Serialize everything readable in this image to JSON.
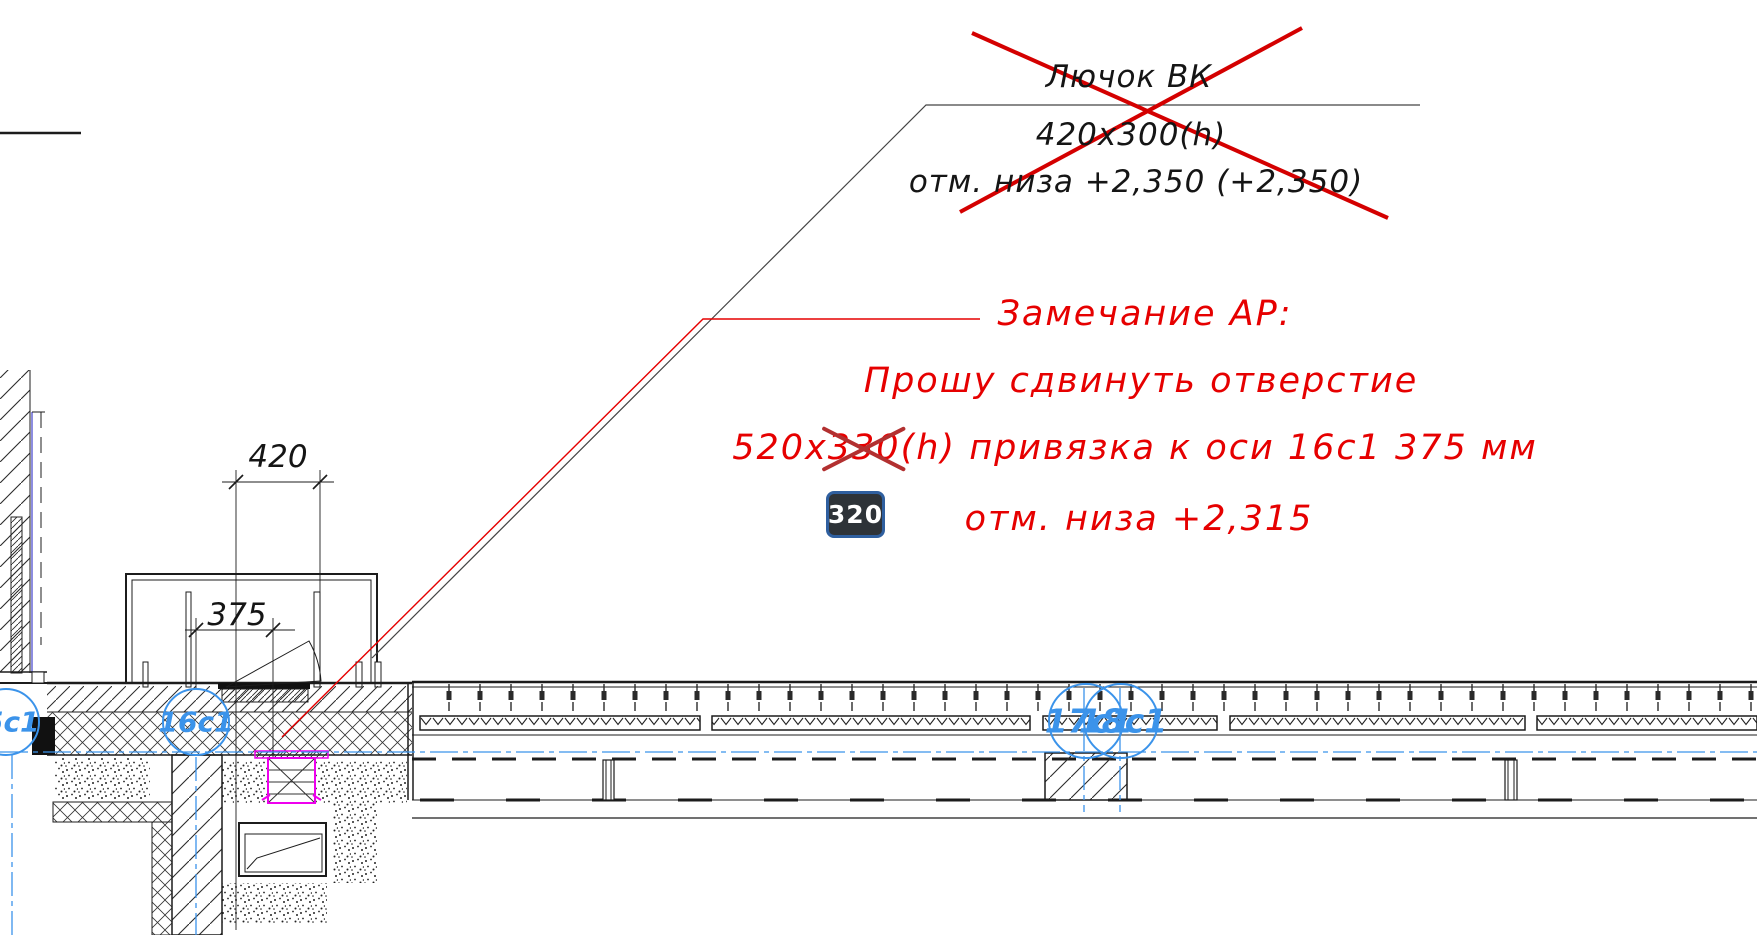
{
  "old_note": {
    "line1": "Лючок ВК",
    "line2": "420х300(h)",
    "line3": "отм. низа  +2,350  (+2,350)"
  },
  "ap_note": {
    "line1": "Замечание АР:",
    "line2": "Прошу сдвинуть отверстие",
    "line3_pre": "520х",
    "line3_strike": "330",
    "line3_post": "(h) привязка к оси  16с1 375 мм",
    "line4": "отм. низа  +2,315"
  },
  "edit_badge": {
    "value": "320"
  },
  "dimensions": {
    "opening_width": "420",
    "axis_offset": "375"
  },
  "axis_bubbles": {
    "a15": "15с1",
    "a16": "16с1",
    "a17": "17с1",
    "a18": "18с1"
  },
  "colors": {
    "annotation_red": "#e60000",
    "cross_red": "#d40000",
    "strike_red": "#b23030",
    "cad_blue": "#3b93ea",
    "highlight_magenta": "#ee00ee",
    "grid_purple": "#8d8de0",
    "badge_bg": "#2e3338",
    "badge_border": "#2f5f9f",
    "badge_text": "#ffffff",
    "linework": "#1c1c1c"
  }
}
